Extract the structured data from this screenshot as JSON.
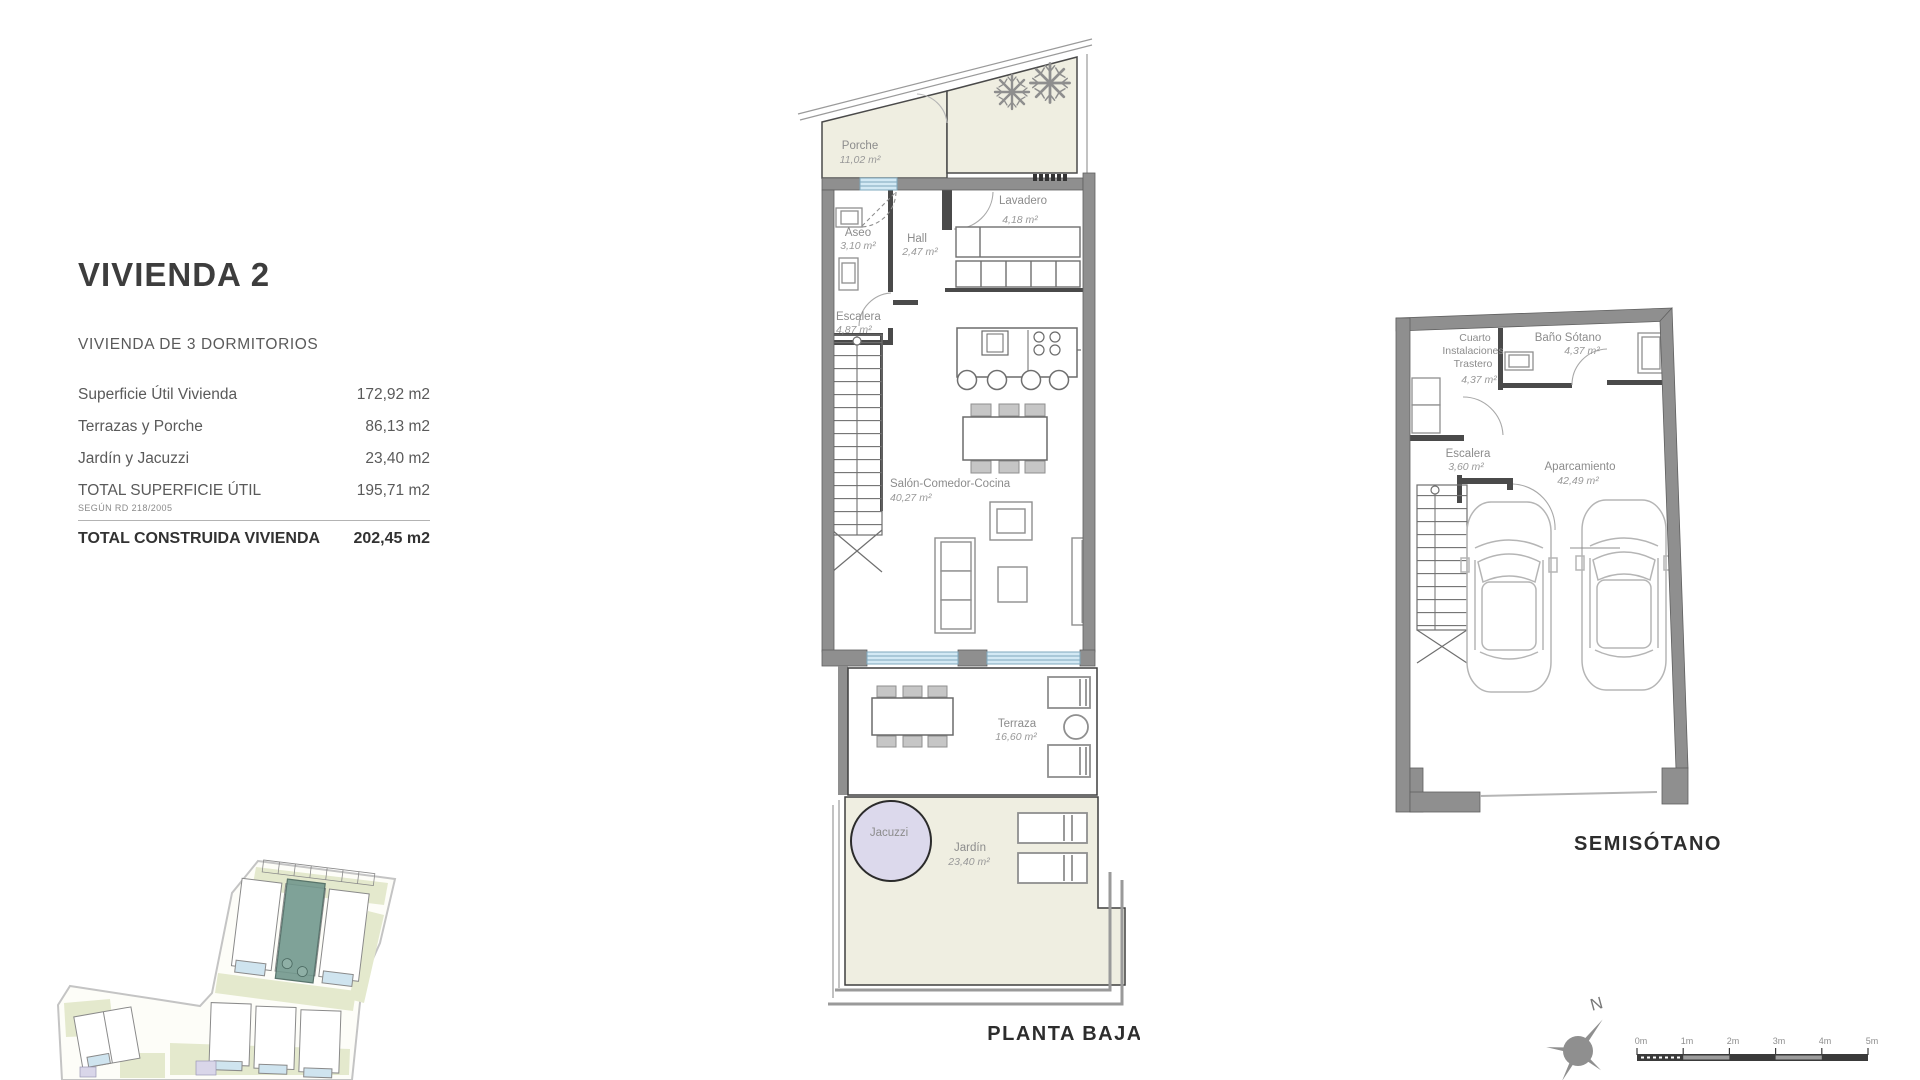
{
  "info_panel": {
    "title": "VIVIENDA 2",
    "subtitle": "VIVIENDA DE 3 DORMITORIOS",
    "rows": [
      {
        "label": "Superficie Útil Vivienda",
        "value": "172,92 m2"
      },
      {
        "label": "Terrazas y Porche",
        "value": "86,13 m2"
      },
      {
        "label": "Jardín y Jacuzzi",
        "value": "23,40 m2"
      },
      {
        "label": "TOTAL SUPERFICIE ÚTIL",
        "value": "195,71 m2",
        "note": "SEGÚN RD 218/2005"
      }
    ],
    "total": {
      "label": "TOTAL CONSTRUIDA VIVIENDA",
      "value": "202,45 m2"
    }
  },
  "planta_baja": {
    "title": "PLANTA BAJA",
    "rooms": {
      "porche": {
        "name": "Porche",
        "area": "11,02 m²"
      },
      "aseo": {
        "name": "Aseo",
        "area": "3,10 m²"
      },
      "hall": {
        "name": "Hall",
        "area": "2,47 m²"
      },
      "lavadero": {
        "name": "Lavadero",
        "area": "4,18 m²"
      },
      "escalera": {
        "name": "Escalera",
        "area": "4,87 m²"
      },
      "salon": {
        "name": "Salón-Comedor-Cocina",
        "area": "40,27 m²"
      },
      "terraza": {
        "name": "Terraza",
        "area": "16,60 m²"
      },
      "jacuzzi": {
        "name": "Jacuzzi"
      },
      "jardin": {
        "name": "Jardín",
        "area": "23,40 m²"
      }
    }
  },
  "semisotano": {
    "title": "SEMISÓTANO",
    "rooms": {
      "cuarto": {
        "lines": [
          "Cuarto",
          "Instalaciones",
          "Trastero"
        ],
        "area": "4,37 m²"
      },
      "bano": {
        "name": "Baño Sótano",
        "area": "4,37 m²"
      },
      "escalera": {
        "name": "Escalera",
        "area": "3,60 m²"
      },
      "aparcamiento": {
        "name": "Aparcamiento",
        "area": "42,49 m²"
      }
    }
  },
  "compass": {
    "north": "N"
  },
  "scale_bar": {
    "ticks": [
      "0m",
      "1m",
      "2m",
      "3m",
      "4m",
      "5m"
    ]
  },
  "colors": {
    "wall_gray": "#8f8f8f",
    "partition_dark": "#4a4a4a",
    "outdoor_cream": "#efeee1",
    "glass_blue": "#d3e9f4",
    "jacuzzi_lavender": "#dcd9ec",
    "site_green": "#e4e9cd",
    "site_pool_blue": "#cfe4ef",
    "highlight_teal": "#72988d",
    "text_dark": "#3d3d3d",
    "text_gray": "#8c8c8c"
  }
}
